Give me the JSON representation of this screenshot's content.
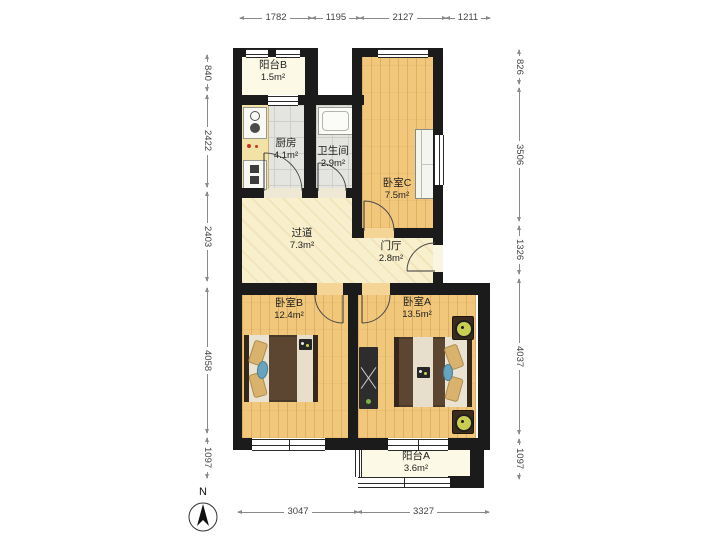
{
  "meta": {
    "north_label": "N"
  },
  "rooms": {
    "balcony_b": {
      "name": "阳台B",
      "area": "1.5m²"
    },
    "kitchen": {
      "name": "厨房",
      "area": "4.1m²"
    },
    "bathroom": {
      "name": "卫生间",
      "area": "2.9m²"
    },
    "bedroom_c": {
      "name": "卧室C",
      "area": "7.5m²"
    },
    "corridor": {
      "name": "过道",
      "area": "7.3m²"
    },
    "hall": {
      "name": "门厅",
      "area": "2.8m²"
    },
    "bedroom_b": {
      "name": "卧室B",
      "area": "12.4m²"
    },
    "bedroom_a": {
      "name": "卧室A",
      "area": "13.5m²"
    },
    "balcony_a": {
      "name": "阳台A",
      "area": "3.6m²"
    }
  },
  "dimensions": {
    "top": [
      "1782",
      "1195",
      "2127",
      "1211"
    ],
    "bottom": [
      "3047",
      "3327"
    ],
    "left": [
      "840",
      "2422",
      "2403",
      "4058",
      "1097"
    ],
    "right": [
      "826",
      "3506",
      "1326",
      "4037",
      "1097"
    ]
  },
  "colors": {
    "wall": "#1b1b1b",
    "wood_floor": "#f1c77c",
    "tile_floor": "#e4e4e1",
    "hall_floor": "#f8efcd",
    "balcony_floor": "#fcfae6",
    "dimension_text": "#444444"
  }
}
